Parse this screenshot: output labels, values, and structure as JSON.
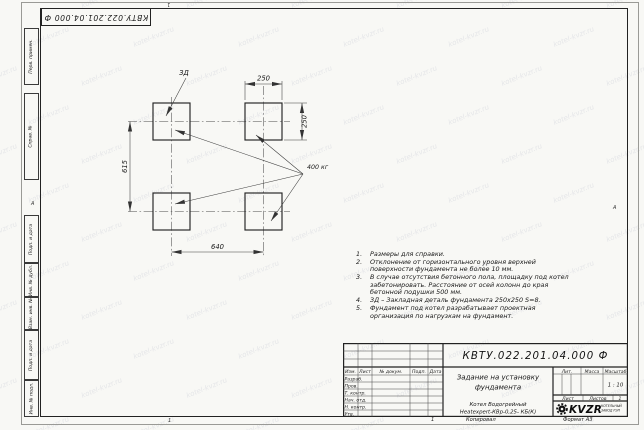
{
  "watermark": {
    "text": "kotel-kvzr.ru"
  },
  "sheet": {
    "top_doc_number": "КВТУ.022.201.04.000 Ф",
    "zone_mark_left": "А",
    "zone_mark_right": "А",
    "fold_mark_top": "1",
    "fold_mark_bottom": "1",
    "footer_sheet_num": "1",
    "footer_copy": "Копировал",
    "footer_format": "Формат А3"
  },
  "side_labels": [
    "Перв. примен.",
    "Справ. №",
    "Подп. и дата",
    "Инв. № дубл.",
    "Взам. инв. №",
    "Подп. и дата",
    "Инв. № подл."
  ],
  "figure": {
    "dim_top": "250",
    "dim_right": "250",
    "dim_left": "615",
    "dim_bottom": "640",
    "embed_label": "ЗД",
    "load_label": "400 кг"
  },
  "notes": [
    {
      "num": "1.",
      "text": "Размеры для справки."
    },
    {
      "num": "2.",
      "text": "Отклонение от горизонтального уровня верхней поверхности фундамента не более 10 мм."
    },
    {
      "num": "3.",
      "text": "В случае отсутствия бетонного пола, площадку под котел забетонировать. Расстояние от осей колонн до края бетонной подушки 500 мм."
    },
    {
      "num": "4.",
      "text": "ЗД – Закладная деталь фундамента 250х250 S=8."
    },
    {
      "num": "5.",
      "text": "Фундамент под котел разрабатывает проектная организация по нагрузкам на фундамент."
    }
  ],
  "stamp": {
    "doc_number": "КВТУ.022.201.04.000 Ф",
    "title_line1": "Задание на установку",
    "title_line2": "фундамента",
    "product_line1": "Котел Водогрейный",
    "product_line2": "Heatexpert-КВр-0,25- КБ(К)",
    "header": {
      "izm": "Изм.",
      "list": "Лист",
      "doc": "№ докум.",
      "podp": "Подп.",
      "data": "Дата"
    },
    "rows": [
      "Разраб.",
      "Пров.",
      "Т. контр.",
      "Нач. отд.",
      "Н. контр.",
      "Утв."
    ],
    "lit_label": "Лит.",
    "mass_label": "Масса",
    "scale_label": "Масштаб",
    "scale_value": "1 : 10",
    "sheet_label": "Лист",
    "sheets_label": "Листов",
    "sheets_value": "1",
    "logo_text": "KVZR",
    "logo_sub1": "КОТЕЛЬНЫЙ",
    "logo_sub2": "ЗАВОД РЭП"
  }
}
